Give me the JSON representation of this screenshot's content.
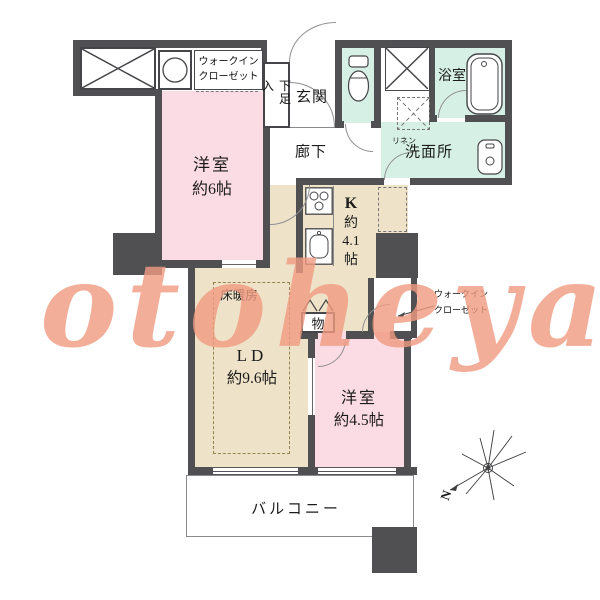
{
  "watermark": {
    "text": "otoheya"
  },
  "compass": {
    "north_label": "N"
  },
  "rooms": {
    "closet_top": {
      "label_line1": "ウォークイン",
      "label_line2": "クローゼット"
    },
    "shoe_cabinet": {
      "label": "下足入"
    },
    "entrance": {
      "label": "玄関"
    },
    "corridor": {
      "label": "廊下"
    },
    "bath": {
      "label": "浴室"
    },
    "washroom": {
      "label": "洗面所"
    },
    "linen": {
      "label": "リネン"
    },
    "bedroom_6": {
      "name": "洋室",
      "size": "約6帖"
    },
    "kitchen": {
      "name": "K",
      "size_line1": "約",
      "size_line2": "4.1",
      "size_line3": "帖"
    },
    "living_dining": {
      "name": "LD",
      "size": "約9.6帖",
      "floor_heating": "床暖房"
    },
    "storage": {
      "label": "物"
    },
    "walk_in_closet": {
      "label_line1": "ウォークイン",
      "label_line2": "クローゼット"
    },
    "bedroom_45": {
      "name": "洋室",
      "size": "約4.5帖"
    },
    "balcony": {
      "label": "バルコニー"
    }
  },
  "colors": {
    "wall": "#505053",
    "bedroom_pink": "#fbdce4",
    "ld_beige": "#eee3c8",
    "wet_area_teal": "#d7f0e6",
    "watermark_salmon": "#f19b82"
  }
}
